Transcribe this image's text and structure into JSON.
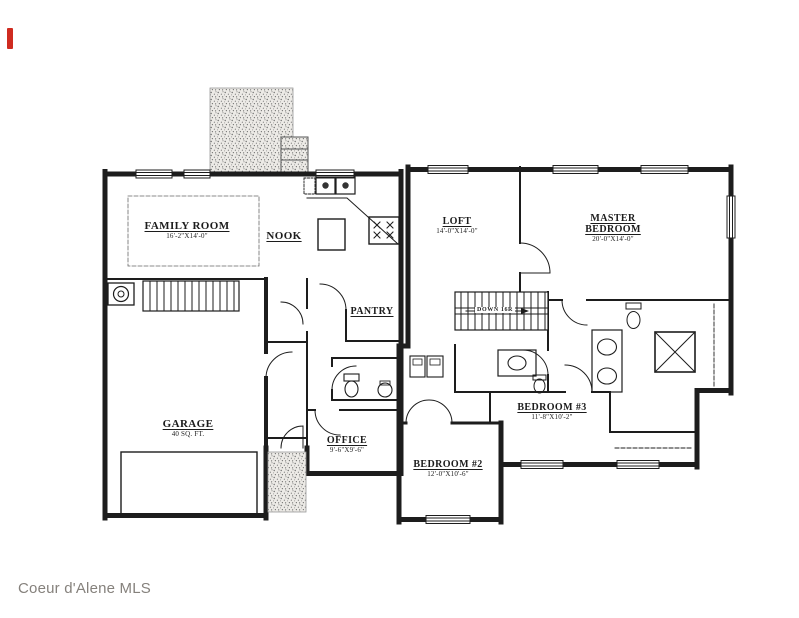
{
  "watermark": "Coeur d'Alene MLS",
  "colors": {
    "line": "#1d1d1d",
    "stipple": "#7e7e7e",
    "watermark_gray": "#85817c",
    "red_mark": "#cf2b20",
    "paper": "#ffffff"
  },
  "first_floor": {
    "family_room": {
      "name": "FAMILY ROOM",
      "dims": "16'-2\"X14'-0\""
    },
    "nook": {
      "name": "NOOK"
    },
    "pantry": {
      "name": "PANTRY"
    },
    "garage": {
      "name": "GARAGE",
      "dims": "40 SQ. FT."
    },
    "office": {
      "name": "OFFICE",
      "dims": "9'-6\"X9'-6\""
    }
  },
  "second_floor": {
    "loft": {
      "name": "LOFT",
      "dims": "14'-0\"X14'-0\""
    },
    "master_bedroom": {
      "name": "MASTER BEDROOM",
      "dims": "20'-0\"X14'-0\""
    },
    "bedroom_3": {
      "name": "BEDROOM #3",
      "dims": "11'-8\"X10'-2\""
    },
    "bedroom_2": {
      "name": "BEDROOM #2",
      "dims": "12'-0\"X10'-6\""
    },
    "stairs": {
      "label": "DOWN 16R"
    }
  }
}
